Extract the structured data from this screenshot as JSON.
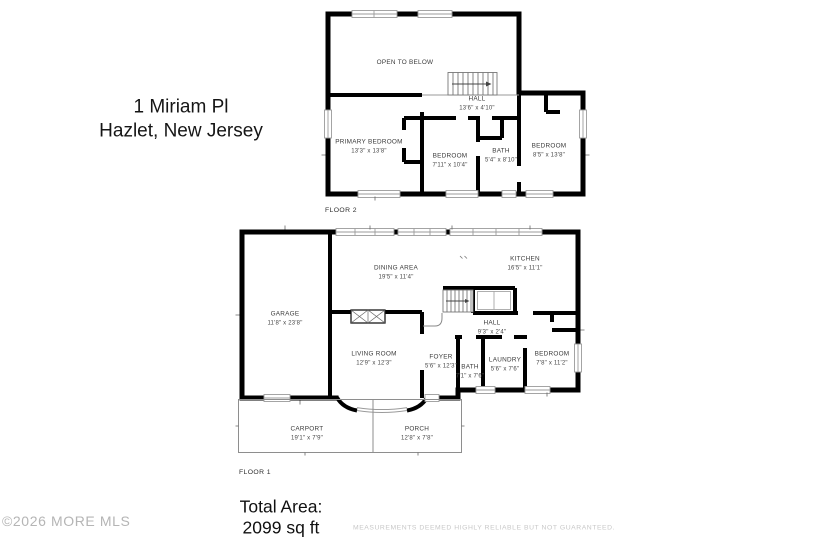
{
  "address": {
    "line1": "1 Miriam Pl",
    "line2": "Hazlet, New Jersey"
  },
  "floor2": {
    "label": "FLOOR 2",
    "open_to_below": {
      "name": "OPEN TO BELOW"
    },
    "hall": {
      "name": "HALL",
      "dims": "13'6\" x 4'10\""
    },
    "primary_bedroom": {
      "name": "PRIMARY BEDROOM",
      "dims": "13'3\" x 13'8\""
    },
    "bedroom_middle": {
      "name": "BEDROOM",
      "dims": "7'11\" x 10'4\""
    },
    "bath": {
      "name": "BATH",
      "dims": "5'4\" x 8'10\""
    },
    "bedroom_right": {
      "name": "BEDROOM",
      "dims": "8'5\" x 13'8\""
    }
  },
  "floor1": {
    "label": "FLOOR 1",
    "garage": {
      "name": "GARAGE",
      "dims": "11'8\" x 23'8\""
    },
    "dining_area": {
      "name": "DINING AREA",
      "dims": "19'5\" x 11'4\""
    },
    "kitchen": {
      "name": "KITCHEN",
      "dims": "16'5\" x 11'1\""
    },
    "hall": {
      "name": "HALL",
      "dims": "9'3\" x 2'4\""
    },
    "living_room": {
      "name": "LIVING ROOM",
      "dims": "12'9\" x 12'3\""
    },
    "foyer": {
      "name": "FOYER",
      "dims": "5'6\" x 12'3\""
    },
    "bath": {
      "name": "BATH",
      "dims": "7'1\" x 7'6\""
    },
    "laundry": {
      "name": "LAUNDRY",
      "dims": "5'6\" x 7'6\""
    },
    "bedroom": {
      "name": "BEDROOM",
      "dims": "7'8\" x 11'2\""
    },
    "carport": {
      "name": "CARPORT",
      "dims": "19'1\" x 7'9\""
    },
    "porch": {
      "name": "PORCH",
      "dims": "12'8\" x 7'8\""
    }
  },
  "total_area": {
    "label": "Total Area:",
    "value": "2099 sq ft"
  },
  "watermark": "©2026 MORE MLS",
  "disclaimer": "MEASUREMENTS DEEMED HIGHLY RELIABLE BUT NOT GUARANTEED.",
  "colors": {
    "wall": "#000000",
    "window_line": "#9b9b9b",
    "label_text": "#3b3b3b",
    "watermark_text": "#b5b5b5",
    "disclaimer_text": "#c8c8c8"
  }
}
